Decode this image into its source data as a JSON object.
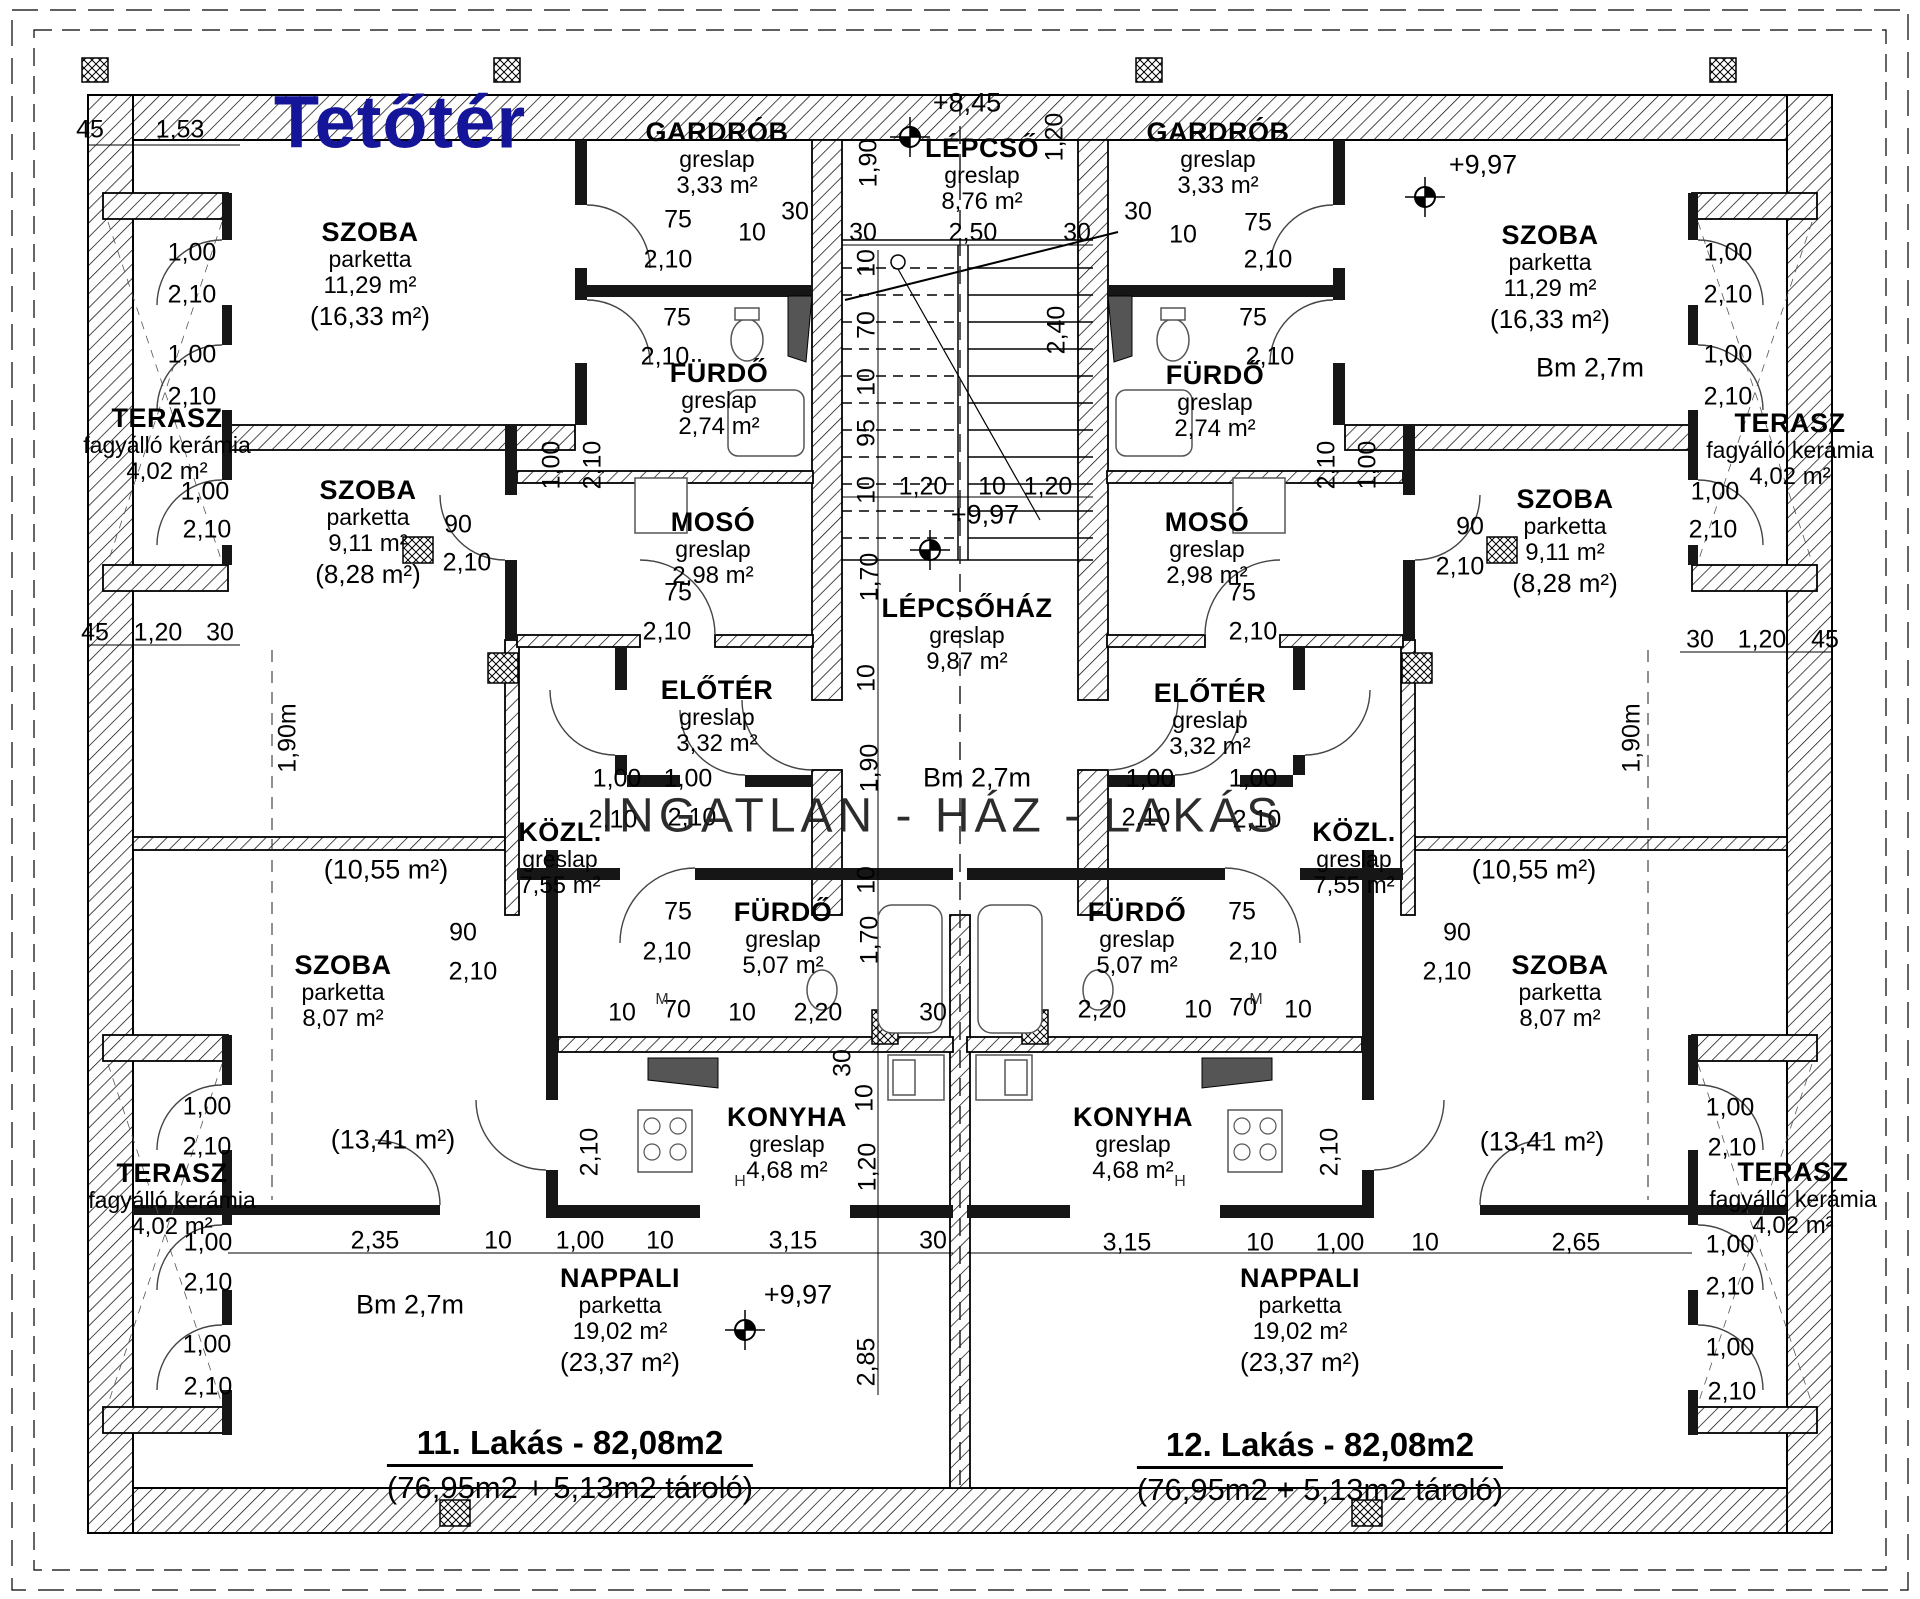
{
  "title": "Tetőtér",
  "watermark": "INGATLAN - HÁZ - LAKÁS",
  "colors": {
    "title": "#15159a",
    "ink": "#000000",
    "watermark": "#1b1b1b"
  },
  "apartments": {
    "left": {
      "title": "11. Lakás - 82,08m2",
      "subtitle": "(76,95m2 + 5,13m2 tároló)",
      "x": 570,
      "y": 1424
    },
    "right": {
      "title": "12. Lakás - 82,08m2",
      "subtitle": "(76,95m2 + 5,13m2 tároló)",
      "x": 1320,
      "y": 1426
    }
  },
  "rooms": [
    {
      "x": 370,
      "y": 217,
      "n": "SZOBA",
      "f": "parketta",
      "a": "11,29 m²",
      "t": "(16,33 m²)"
    },
    {
      "x": 717,
      "y": 117,
      "n": "GARDRÓB",
      "f": "greslap",
      "a": "3,33 m²",
      "t": null
    },
    {
      "x": 982,
      "y": 133,
      "n": "LÉPCSŐ",
      "f": "greslap",
      "a": "8,76 m²",
      "t": null
    },
    {
      "x": 1218,
      "y": 117,
      "n": "GARDRÓB",
      "f": "greslap",
      "a": "3,33 m²",
      "t": null
    },
    {
      "x": 1550,
      "y": 220,
      "n": "SZOBA",
      "f": "parketta",
      "a": "11,29 m²",
      "t": "(16,33 m²)"
    },
    {
      "x": 719,
      "y": 358,
      "n": "FÜRDŐ",
      "f": "greslap",
      "a": "2,74 m²",
      "t": null
    },
    {
      "x": 1215,
      "y": 360,
      "n": "FÜRDŐ",
      "f": "greslap",
      "a": "2,74 m²",
      "t": null
    },
    {
      "x": 167,
      "y": 403,
      "n": "TERASZ",
      "f": "fagyálló kerámia",
      "a": "4,02 m²",
      "t": null
    },
    {
      "x": 1790,
      "y": 408,
      "n": "TERASZ",
      "f": "fagyálló kerámia",
      "a": "4,02 m²",
      "t": null
    },
    {
      "x": 368,
      "y": 475,
      "n": "SZOBA",
      "f": "parketta",
      "a": "9,11 m²",
      "t": "(8,28 m²)"
    },
    {
      "x": 1565,
      "y": 484,
      "n": "SZOBA",
      "f": "parketta",
      "a": "9,11 m²",
      "t": "(8,28 m²)"
    },
    {
      "x": 713,
      "y": 507,
      "n": "MOSÓ",
      "f": "greslap",
      "a": "2,98 m²",
      "t": null
    },
    {
      "x": 1207,
      "y": 507,
      "n": "MOSÓ",
      "f": "greslap",
      "a": "2,98 m²",
      "t": null
    },
    {
      "x": 967,
      "y": 593,
      "n": "LÉPCSŐHÁZ",
      "f": "greslap",
      "a": "9,87 m²",
      "t": null
    },
    {
      "x": 717,
      "y": 675,
      "n": "ELŐTÉR",
      "f": "greslap",
      "a": "3,32 m²",
      "t": null
    },
    {
      "x": 1210,
      "y": 678,
      "n": "ELŐTÉR",
      "f": "greslap",
      "a": "3,32 m²",
      "t": null
    },
    {
      "x": 560,
      "y": 817,
      "n": "KÖZL.",
      "f": "greslap",
      "a": "7,55 m²",
      "t": null
    },
    {
      "x": 1354,
      "y": 817,
      "n": "KÖZL.",
      "f": "greslap",
      "a": "7,55 m²",
      "t": null
    },
    {
      "x": 783,
      "y": 897,
      "n": "FÜRDŐ",
      "f": "greslap",
      "a": "5,07 m²",
      "t": null
    },
    {
      "x": 1137,
      "y": 897,
      "n": "FÜRDŐ",
      "f": "greslap",
      "a": "5,07 m²",
      "t": null
    },
    {
      "x": 343,
      "y": 950,
      "n": "SZOBA",
      "f": "parketta",
      "a": "8,07 m²",
      "t": null
    },
    {
      "x": 1560,
      "y": 950,
      "n": "SZOBA",
      "f": "parketta",
      "a": "8,07 m²",
      "t": null
    },
    {
      "x": 787,
      "y": 1102,
      "n": "KONYHA",
      "f": "greslap",
      "a": "4,68 m²",
      "t": null
    },
    {
      "x": 1133,
      "y": 1102,
      "n": "KONYHA",
      "f": "greslap",
      "a": "4,68 m²",
      "t": null
    },
    {
      "x": 172,
      "y": 1158,
      "n": "TERASZ",
      "f": "fagyálló kerámia",
      "a": "4,02 m²",
      "t": null
    },
    {
      "x": 1793,
      "y": 1157,
      "n": "TERASZ",
      "f": "fagyálló kerámia",
      "a": "4,02 m²",
      "t": null
    },
    {
      "x": 620,
      "y": 1263,
      "n": "NAPPALI",
      "f": "parketta",
      "a": "19,02 m²",
      "t": "(23,37 m²)"
    },
    {
      "x": 1300,
      "y": 1263,
      "n": "NAPPALI",
      "f": "parketta",
      "a": "19,02 m²",
      "t": "(23,37 m²)"
    }
  ],
  "area_notes": [
    {
      "t": "(10,55 m²)",
      "x": 386,
      "y": 870
    },
    {
      "t": "(10,55 m²)",
      "x": 1534,
      "y": 870
    },
    {
      "t": "(13,41 m²)",
      "x": 393,
      "y": 1140
    },
    {
      "t": "(13,41 m²)",
      "x": 1542,
      "y": 1142
    }
  ],
  "level_marks": [
    {
      "t": "+8,45",
      "x": 967,
      "y": 103
    },
    {
      "t": "+9,97",
      "x": 985,
      "y": 515
    },
    {
      "t": "+9,97",
      "x": 1483,
      "y": 165
    },
    {
      "t": "+9,97",
      "x": 798,
      "y": 1295
    }
  ],
  "height_notes": [
    {
      "t": "Bm 2,7m",
      "x": 977,
      "y": 778
    },
    {
      "t": "Bm 2,7m",
      "x": 1590,
      "y": 368
    },
    {
      "t": "Bm 2,7m",
      "x": 410,
      "y": 1305
    }
  ],
  "small_notes": [
    {
      "t": "M",
      "x": 662,
      "y": 1000
    },
    {
      "t": "M",
      "x": 1256,
      "y": 1000
    },
    {
      "t": "H",
      "x": 740,
      "y": 1182
    },
    {
      "t": "H",
      "x": 1180,
      "y": 1182
    }
  ],
  "survey_markers": [
    {
      "x": 910,
      "y": 137
    },
    {
      "x": 930,
      "y": 550
    },
    {
      "x": 1425,
      "y": 197
    },
    {
      "x": 745,
      "y": 1330
    }
  ],
  "dims": [
    {
      "t": "45",
      "x": 90,
      "y": 130
    },
    {
      "t": "1,53",
      "x": 180,
      "y": 130
    },
    {
      "t": "75",
      "x": 678,
      "y": 220
    },
    {
      "t": "2,10",
      "x": 668,
      "y": 260
    },
    {
      "t": "10",
      "x": 752,
      "y": 233
    },
    {
      "t": "30",
      "x": 795,
      "y": 212
    },
    {
      "t": "1,90",
      "x": 869,
      "y": 163,
      "v": 1
    },
    {
      "t": "1,20",
      "x": 1055,
      "y": 137,
      "v": 1
    },
    {
      "t": "30",
      "x": 863,
      "y": 233
    },
    {
      "t": "2,50",
      "x": 973,
      "y": 233
    },
    {
      "t": "30",
      "x": 1077,
      "y": 233
    },
    {
      "t": "30",
      "x": 1138,
      "y": 212
    },
    {
      "t": "10",
      "x": 1183,
      "y": 235
    },
    {
      "t": "75",
      "x": 1258,
      "y": 223
    },
    {
      "t": "2,10",
      "x": 1268,
      "y": 260
    },
    {
      "t": "1,00",
      "x": 192,
      "y": 253
    },
    {
      "t": "2,10",
      "x": 192,
      "y": 295
    },
    {
      "t": "75",
      "x": 677,
      "y": 318
    },
    {
      "t": "2,10",
      "x": 665,
      "y": 357
    },
    {
      "t": "10",
      "x": 867,
      "y": 263,
      "v": 1
    },
    {
      "t": "70",
      "x": 867,
      "y": 325,
      "v": 1
    },
    {
      "t": "10",
      "x": 867,
      "y": 382,
      "v": 1
    },
    {
      "t": "95",
      "x": 867,
      "y": 433,
      "v": 1
    },
    {
      "t": "2,40",
      "x": 1057,
      "y": 330,
      "v": 1
    },
    {
      "t": "75",
      "x": 1253,
      "y": 318
    },
    {
      "t": "2,10",
      "x": 1270,
      "y": 357
    },
    {
      "t": "1,00",
      "x": 1728,
      "y": 253
    },
    {
      "t": "2,10",
      "x": 1728,
      "y": 295
    },
    {
      "t": "1,00",
      "x": 192,
      "y": 355
    },
    {
      "t": "2,10",
      "x": 192,
      "y": 397
    },
    {
      "t": "1,00",
      "x": 1728,
      "y": 355
    },
    {
      "t": "2,10",
      "x": 1728,
      "y": 397
    },
    {
      "t": "1,00",
      "x": 552,
      "y": 465,
      "v": 1
    },
    {
      "t": "2,10",
      "x": 593,
      "y": 465,
      "v": 1
    },
    {
      "t": "1,00",
      "x": 1368,
      "y": 465,
      "v": 1
    },
    {
      "t": "2,10",
      "x": 1327,
      "y": 465,
      "v": 1
    },
    {
      "t": "1,00",
      "x": 205,
      "y": 492
    },
    {
      "t": "2,10",
      "x": 207,
      "y": 530
    },
    {
      "t": "1,00",
      "x": 1715,
      "y": 492
    },
    {
      "t": "2,10",
      "x": 1713,
      "y": 530
    },
    {
      "t": "90",
      "x": 458,
      "y": 525
    },
    {
      "t": "2,10",
      "x": 467,
      "y": 563
    },
    {
      "t": "90",
      "x": 1470,
      "y": 527
    },
    {
      "t": "2,10",
      "x": 1460,
      "y": 567
    },
    {
      "t": "1,20",
      "x": 923,
      "y": 487
    },
    {
      "t": "10",
      "x": 992,
      "y": 487
    },
    {
      "t": "1,20",
      "x": 1048,
      "y": 487
    },
    {
      "t": "10",
      "x": 867,
      "y": 490,
      "v": 1
    },
    {
      "t": "1,70",
      "x": 870,
      "y": 577,
      "v": 1
    },
    {
      "t": "75",
      "x": 678,
      "y": 593
    },
    {
      "t": "2,10",
      "x": 667,
      "y": 632
    },
    {
      "t": "75",
      "x": 1242,
      "y": 593
    },
    {
      "t": "2,10",
      "x": 1253,
      "y": 632
    },
    {
      "t": "45",
      "x": 95,
      "y": 633
    },
    {
      "t": "1,20",
      "x": 158,
      "y": 633
    },
    {
      "t": "30",
      "x": 220,
      "y": 633
    },
    {
      "t": "30",
      "x": 1700,
      "y": 640
    },
    {
      "t": "1,20",
      "x": 1762,
      "y": 640
    },
    {
      "t": "45",
      "x": 1825,
      "y": 640
    },
    {
      "t": "1,90m",
      "x": 288,
      "y": 738,
      "v": 1
    },
    {
      "t": "1,90m",
      "x": 1632,
      "y": 738,
      "v": 1
    },
    {
      "t": "10",
      "x": 867,
      "y": 678,
      "v": 1
    },
    {
      "t": "1,90",
      "x": 870,
      "y": 768,
      "v": 1
    },
    {
      "t": "1,00",
      "x": 617,
      "y": 779
    },
    {
      "t": "2,10",
      "x": 613,
      "y": 820
    },
    {
      "t": "1,00",
      "x": 688,
      "y": 779
    },
    {
      "t": "2,10",
      "x": 692,
      "y": 818
    },
    {
      "t": "1,00",
      "x": 1150,
      "y": 779
    },
    {
      "t": "2,10",
      "x": 1146,
      "y": 818
    },
    {
      "t": "1,00",
      "x": 1253,
      "y": 779
    },
    {
      "t": "2,10",
      "x": 1257,
      "y": 820
    },
    {
      "t": "10",
      "x": 867,
      "y": 880,
      "v": 1
    },
    {
      "t": "1,70",
      "x": 870,
      "y": 940,
      "v": 1
    },
    {
      "t": "75",
      "x": 678,
      "y": 912
    },
    {
      "t": "2,10",
      "x": 667,
      "y": 952
    },
    {
      "t": "75",
      "x": 1242,
      "y": 912
    },
    {
      "t": "2,10",
      "x": 1253,
      "y": 952
    },
    {
      "t": "90",
      "x": 463,
      "y": 933
    },
    {
      "t": "2,10",
      "x": 473,
      "y": 972
    },
    {
      "t": "90",
      "x": 1457,
      "y": 933
    },
    {
      "t": "2,10",
      "x": 1447,
      "y": 972
    },
    {
      "t": "10",
      "x": 622,
      "y": 1013
    },
    {
      "t": "70",
      "x": 677,
      "y": 1010
    },
    {
      "t": "10",
      "x": 742,
      "y": 1013
    },
    {
      "t": "2,20",
      "x": 818,
      "y": 1013
    },
    {
      "t": "30",
      "x": 933,
      "y": 1013
    },
    {
      "t": "2,20",
      "x": 1102,
      "y": 1010
    },
    {
      "t": "10",
      "x": 1198,
      "y": 1010
    },
    {
      "t": "70",
      "x": 1243,
      "y": 1008
    },
    {
      "t": "10",
      "x": 1298,
      "y": 1010
    },
    {
      "t": "30",
      "x": 843,
      "y": 1063,
      "v": 1
    },
    {
      "t": "10",
      "x": 865,
      "y": 1098,
      "v": 1
    },
    {
      "t": "1,20",
      "x": 868,
      "y": 1167,
      "v": 1
    },
    {
      "t": "2,10",
      "x": 590,
      "y": 1152,
      "v": 1
    },
    {
      "t": "2,10",
      "x": 1330,
      "y": 1152,
      "v": 1
    },
    {
      "t": "1,00",
      "x": 207,
      "y": 1107
    },
    {
      "t": "2,10",
      "x": 207,
      "y": 1147
    },
    {
      "t": "1,00",
      "x": 1730,
      "y": 1108
    },
    {
      "t": "2,10",
      "x": 1732,
      "y": 1148
    },
    {
      "t": "2,35",
      "x": 375,
      "y": 1241
    },
    {
      "t": "10",
      "x": 498,
      "y": 1241
    },
    {
      "t": "1,00",
      "x": 580,
      "y": 1241
    },
    {
      "t": "10",
      "x": 660,
      "y": 1241
    },
    {
      "t": "3,15",
      "x": 793,
      "y": 1241
    },
    {
      "t": "30",
      "x": 933,
      "y": 1241
    },
    {
      "t": "3,15",
      "x": 1127,
      "y": 1243
    },
    {
      "t": "10",
      "x": 1260,
      "y": 1243
    },
    {
      "t": "1,00",
      "x": 1340,
      "y": 1243
    },
    {
      "t": "10",
      "x": 1425,
      "y": 1243
    },
    {
      "t": "2,65",
      "x": 1576,
      "y": 1243
    },
    {
      "t": "1,00",
      "x": 208,
      "y": 1243
    },
    {
      "t": "2,10",
      "x": 208,
      "y": 1283
    },
    {
      "t": "1,00",
      "x": 1730,
      "y": 1245
    },
    {
      "t": "2,10",
      "x": 1730,
      "y": 1287
    },
    {
      "t": "1,00",
      "x": 207,
      "y": 1345
    },
    {
      "t": "2,10",
      "x": 208,
      "y": 1387
    },
    {
      "t": "1,00",
      "x": 1730,
      "y": 1348
    },
    {
      "t": "2,10",
      "x": 1732,
      "y": 1392
    },
    {
      "t": "2,85",
      "x": 867,
      "y": 1362,
      "v": 1
    }
  ]
}
